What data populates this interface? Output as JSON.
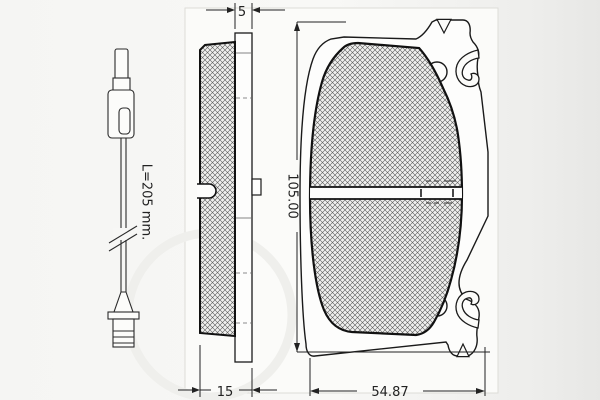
{
  "drawing": {
    "background_color": "#f5f5f3",
    "panel_color": "#fbfbf9",
    "line_color": "#1a1a1a",
    "sensor_view": {
      "name": "wear indicator sensor",
      "length_label": "L=205 mm."
    },
    "side_view": {
      "name": "brake pad side profile",
      "plate_thickness_label": "5",
      "total_thickness_label": "15"
    },
    "front_view": {
      "name": "brake pad front profile",
      "height_label": "105.00",
      "width_label": "54.87"
    }
  }
}
